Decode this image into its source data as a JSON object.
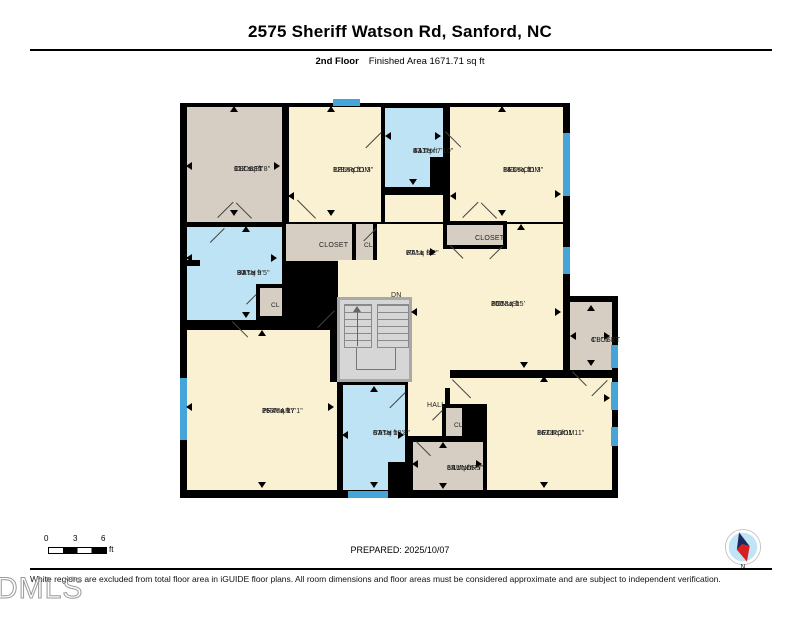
{
  "header": {
    "title": "2575 Sheriff Watson Rd, Sanford, NC",
    "floor_label": "2nd Floor",
    "area_label": "Finished Area 1671.71 sq ft"
  },
  "rooms": {
    "closet_tl": {
      "name": "CLOSET",
      "dims": "9'8\" x 11'8\"",
      "area": "113 sq ft"
    },
    "bedroom_t1": {
      "name": "BEDROOM",
      "dims": "12'5\" x 11'3\"",
      "area": "118 sq ft"
    },
    "bath_t": {
      "name": "BATH",
      "dims": "5'11\" x 7'10\"",
      "area": "43 sq ft"
    },
    "bedroom_t2": {
      "name": "BEDROOM",
      "dims": "15'6\" x 11'3\"",
      "area": "143 sq ft"
    },
    "bath_ml": {
      "name": "BATH",
      "dims": "9'8\" x 9'5\"",
      "area": "80 sq ft"
    },
    "cl_bath": {
      "name": "CL"
    },
    "closet_m": {
      "name": "CLOSET"
    },
    "cl_m": {
      "name": "CL"
    },
    "hall_m": {
      "name": "HALL",
      "dims": "6'5\" x 8'2\"",
      "area": "77 sq ft"
    },
    "closet_tc": {
      "name": "CLOSET"
    },
    "bonus": {
      "name": "BONUS",
      "dims": "15'5\" x 15'",
      "area": "200 sq ft"
    },
    "closet_r": {
      "name": "CLOSET",
      "dims": "4'8\" x 7'"
    },
    "primary": {
      "name": "PRIMARY",
      "dims": "15'4\" x 17'1\"",
      "area": "263 sq ft"
    },
    "bath_b": {
      "name": "BATH",
      "dims": "6'9\" x 10'8\"",
      "area": "67 sq ft"
    },
    "hall_b": {
      "name": "HALL"
    },
    "cl_b": {
      "name": "CL"
    },
    "laundry": {
      "name": "LAUNDRY",
      "dims": "6'11\" x 5'5\"",
      "area": "38 sq ft"
    },
    "bedroom_br": {
      "name": "BEDROOM",
      "dims": "16'11\" x 11'11\"",
      "area": "167 sq ft"
    },
    "stairs": {
      "label": "DN"
    }
  },
  "footer": {
    "scale_ticks": [
      "0",
      "3",
      "6"
    ],
    "scale_unit": "ft",
    "prepared": "PREPARED: 2025/10/07",
    "compass_label": "N",
    "disclaimer": "White regions are excluded from total floor area in iGUIDE floor plans. All room dimensions and floor areas must be considered approximate and are subject to independent verification.",
    "watermark": "DMLS"
  },
  "colors": {
    "room": "#FAF1D3",
    "closet": "#D6CEC2",
    "bath": "#BEE3F4",
    "window": "#45A4D8",
    "wall": "#000000",
    "stairs": "#D6D6D6"
  }
}
